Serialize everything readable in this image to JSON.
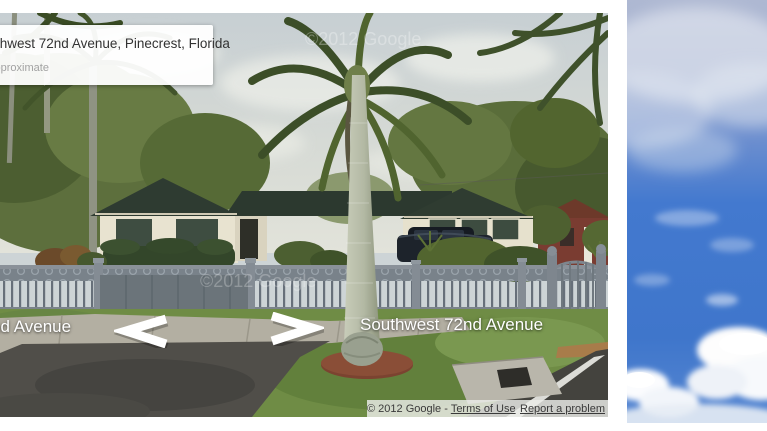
{
  "address_box": {
    "title": "Southwest 72nd Avenue, Pinecrest, Florida",
    "subtitle": "Address is approximate"
  },
  "street_labels": {
    "left": "Southwest 72nd Avenue",
    "right": "Southwest 72nd Avenue"
  },
  "watermarks": {
    "sky": "©2012 Google",
    "ground": "©2012 Google"
  },
  "attribution": {
    "copyright": "© 2012 Google -",
    "terms_link": "Terms of Use",
    "report_link": "Report a problem"
  },
  "colors": {
    "sky_blue": "#4379cf",
    "pano_sky": "#ccd3d4",
    "roof_green": "#2e3b31",
    "wall_cream": "#e8e3d0",
    "shutter_green": "#3e4d41",
    "fence_gray": "#7a838b",
    "lawn_green": "#6f8c45",
    "mulch_red": "#7b4330",
    "label_text": "#ffffff",
    "copyright_text": "#3a3a3a"
  }
}
